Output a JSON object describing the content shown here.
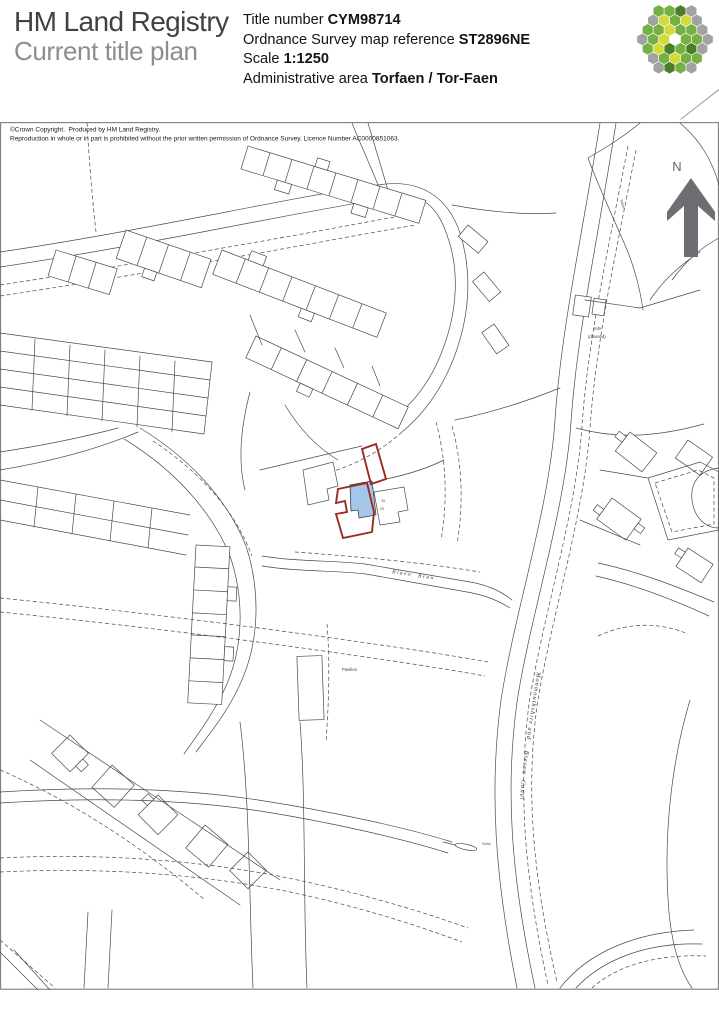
{
  "header": {
    "brand_line1": "HM Land Registry",
    "brand_line2": "Current title plan",
    "fields": [
      {
        "label": "Title number ",
        "value": "CYM98714"
      },
      {
        "label": "Ordnance Survey map reference ",
        "value": "ST2896NE"
      },
      {
        "label": "Scale ",
        "value": "1:1250"
      },
      {
        "label": "Administrative area ",
        "value": "Torfaen / Tor-Faen"
      }
    ],
    "logo": {
      "name": "hm-land-registry-hexagon-logo",
      "palette": {
        "g": "#76b043",
        "l": "#d3da3a",
        "d": "#4c7d27",
        "y": "#a0a2a4",
        "w": "#ffffff"
      },
      "rows": [
        [
          "g",
          "g",
          "d",
          "y"
        ],
        [
          "y",
          "l",
          "g",
          "l",
          "y"
        ],
        [
          "g",
          "g",
          "l",
          "g",
          "g",
          "y"
        ],
        [
          "y",
          "g",
          "l",
          "w",
          "g",
          "g",
          "y"
        ],
        [
          "g",
          "l",
          "d",
          "g",
          "d",
          "y"
        ],
        [
          "y",
          "g",
          "l",
          "g",
          "g"
        ],
        [
          "y",
          "d",
          "g",
          "y"
        ]
      ]
    }
  },
  "map": {
    "copyright_line1": "©Crown Copyright.  Produced by HM Land Registry.",
    "copyright_line2": "Reproduction in whole or in part is prohibited without the prior written permission of Ordnance Survey. Licence Number AC0000851063.",
    "labels": {
      "north": "N",
      "canal": "Monmouthshire and    Brecon  Canal",
      "stream": "Blaen  Bran",
      "kiln_line1": "Kiln",
      "kiln_line2": "(disused)",
      "pavilion": "Pavilion",
      "sinks": "Sinks",
      "water": "Water",
      "plot_no_a": "39",
      "plot_no_b": "20"
    },
    "colors": {
      "map_line": "#4a4a4a",
      "red_boundary": "#9b2a20",
      "building_fill": "#a5c6e9",
      "north_arrow": "#6d6e71"
    }
  }
}
